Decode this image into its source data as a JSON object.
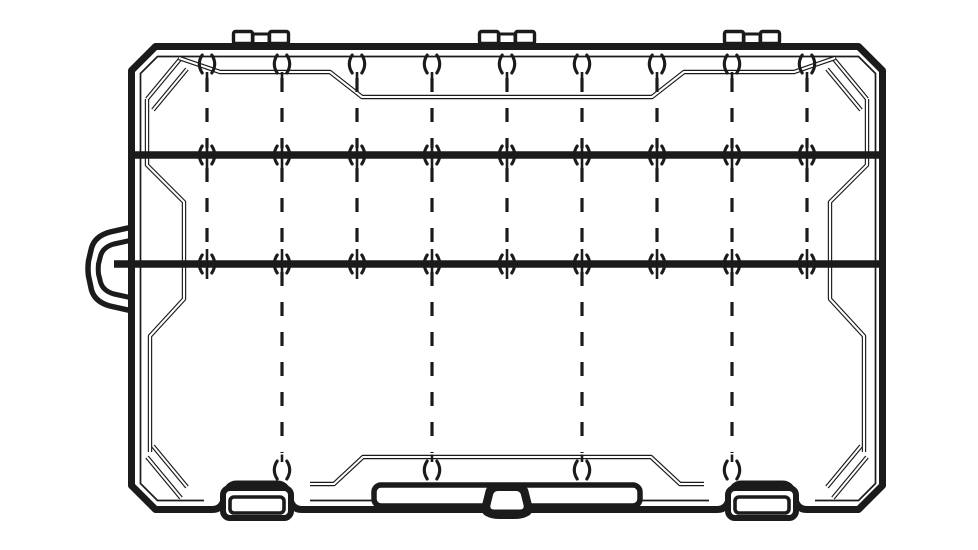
{
  "palette": {
    "line": "#1b1b1b",
    "background": "#ffffff"
  },
  "canvas": {
    "width": 978,
    "height": 550
  },
  "diagram_title": "",
  "geometry": {
    "case": {
      "left": 128,
      "top": 43,
      "right": 886,
      "bottom": 513,
      "edge_stroke": 7,
      "chamfer": 24
    },
    "rim": {
      "left": 140.5,
      "top": 56.5,
      "right": 875.5,
      "bottom": 500.5,
      "chamfer": 17,
      "stroke": 1.7
    },
    "mirror_x_sum": 1014,
    "mirror_y_sum": 556,
    "hinges": {
      "count": 3,
      "centers_x": [
        261,
        507,
        752
      ],
      "tab_w": 19,
      "tab_h": 12,
      "tab_y": 31.5,
      "mid_w": 16,
      "mid_h": 9.5,
      "mid_y": 34
    },
    "latches": {
      "count": 2,
      "centers_x": [
        257,
        762
      ],
      "clip_w": 68,
      "clip_h": 30,
      "clip_y": 488,
      "inner_w": 54,
      "inner_h": 16,
      "inner_y": 497
    },
    "carry_handle": {
      "side": "left",
      "attach_x": 132,
      "top": 227,
      "bottom": 311
    },
    "bottom_pull": {
      "center_x": 507,
      "top": 485,
      "bottom": 519
    },
    "label_recess": {
      "x": 374,
      "y": 485,
      "width": 266,
      "height": 21
    },
    "divider_bars": {
      "count": 2,
      "ys": [
        155,
        264
      ],
      "x1": 135,
      "x2": 880,
      "stroke": 7.5,
      "bar2_x1": 114
    },
    "slot_columns": {
      "upper_x": [
        207,
        282,
        357,
        432,
        507,
        582,
        657,
        732,
        807
      ],
      "lower_x": [
        282,
        432,
        582,
        732
      ],
      "dash_spans": {
        "upper": [
          78,
          148
        ],
        "middle": [
          168,
          257
        ],
        "lower": [
          272,
          453
        ]
      },
      "dash": {
        "len": 14,
        "gap": 16,
        "width": 3.2
      }
    },
    "notches": {
      "top_row_y": 64,
      "bottom_row_y": 470,
      "arc_halfheight": 9,
      "arc_reach": 10.6
    },
    "deco": {
      "corner_bevel_a": [
        [
          147,
          99
        ],
        [
          181,
          58
        ]
      ],
      "corner_bevel_b": [
        [
          153,
          110
        ],
        [
          187,
          69
        ]
      ],
      "side_panel_left": [
        [
          147,
          99
        ],
        [
          147,
          165
        ],
        [
          184,
          202
        ],
        [
          184,
          299
        ],
        [
          150,
          336
        ],
        [
          150,
          452
        ]
      ],
      "top_band": [
        [
          179,
          58
        ],
        [
          220,
          72
        ],
        [
          330,
          72
        ],
        [
          362,
          97
        ],
        [
          652,
          97
        ],
        [
          684,
          72
        ],
        [
          794,
          72
        ],
        [
          835,
          58
        ]
      ],
      "bottom_band": [
        [
          310,
          484
        ],
        [
          334,
          484
        ],
        [
          363,
          457
        ],
        [
          651,
          457
        ],
        [
          680,
          484
        ],
        [
          704,
          484
        ]
      ]
    }
  },
  "parts_legend": [
    {
      "name": "lid hinge",
      "count": 3
    },
    {
      "name": "latch clip",
      "count": 2
    },
    {
      "name": "carry handle",
      "count": 1
    },
    {
      "name": "bottom pull tab",
      "count": 1
    },
    {
      "name": "fixed divider bar",
      "count": 2
    },
    {
      "name": "adjustable divider slot column (upper)",
      "count": 9
    },
    {
      "name": "adjustable divider slot column (lower)",
      "count": 4
    },
    {
      "name": "divider notch (top row)",
      "count": 9
    },
    {
      "name": "divider notch (per bar)",
      "count": 9
    },
    {
      "name": "divider notch (bottom row)",
      "count": 4
    }
  ]
}
